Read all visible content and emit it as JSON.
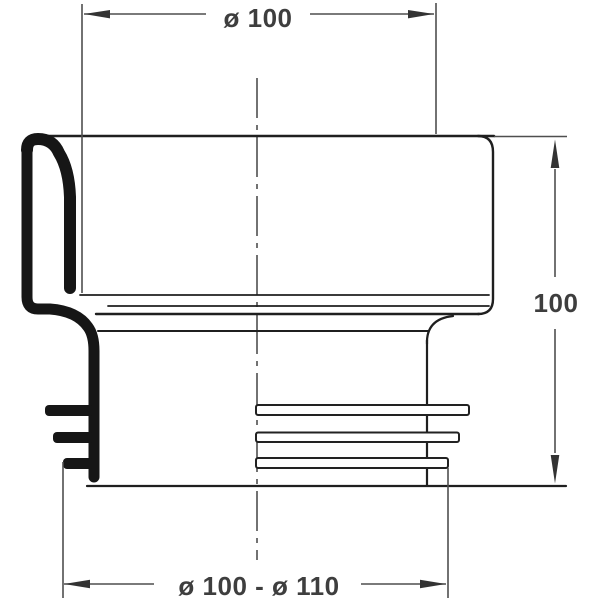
{
  "drawing": {
    "type": "technical-drawing",
    "subject": "pipe-connector-cross-section",
    "dimensions": {
      "top_diameter": "ø 100",
      "height": "100",
      "bottom_diameter_range": "ø 100 - ø 110"
    },
    "colors": {
      "background": "#ffffff",
      "outline": "#1f1f1f",
      "section_fill": "#161616",
      "dimension_line": "#4f4f4f",
      "label_text": "#3e3e3e"
    }
  }
}
